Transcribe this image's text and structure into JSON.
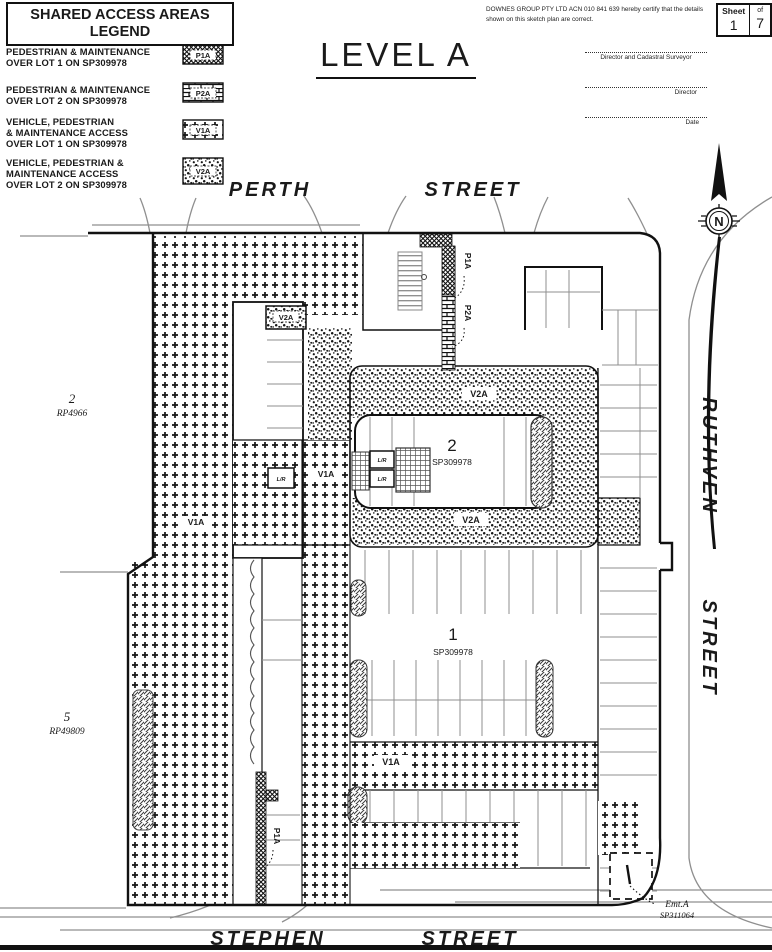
{
  "doc": {
    "title": "LEVEL A",
    "sheet": {
      "label": "Sheet",
      "of_label": "of",
      "number": "1",
      "total": "7"
    },
    "certification": {
      "line1": "DOWNES GROUP PTY LTD  ACN 010 841 639 hereby certify that the details",
      "line2": "shown on this sketch plan are correct."
    },
    "signatures": {
      "s1": "Director and Cadastral Surveyor",
      "s2": "Director",
      "s3": "Date"
    }
  },
  "legend": {
    "title1": "SHARED ACCESS AREAS",
    "title2": "LEGEND",
    "items": [
      {
        "lines": [
          "PEDESTRIAN & MAINTENANCE",
          "OVER LOT 1 ON SP309978"
        ],
        "code": "P1A"
      },
      {
        "lines": [
          "PEDESTRIAN & MAINTENANCE",
          "OVER LOT 2 ON SP309978"
        ],
        "code": "P2A"
      },
      {
        "lines": [
          "VEHICLE, PEDESTRIAN",
          "& MAINTENANCE ACCESS",
          "OVER LOT 1 ON SP309978"
        ],
        "code": "V1A"
      },
      {
        "lines": [
          "VEHICLE, PEDESTRIAN &",
          "MAINTENANCE ACCESS",
          "OVER LOT 2 ON SP309978"
        ],
        "code": "V2A"
      }
    ]
  },
  "streets": {
    "perth": "PERTH",
    "street_top": "STREET",
    "ruthven": "RUTHVEN",
    "street_right": "STREET",
    "stephen": "STEPHEN",
    "street_bottom": "STREET"
  },
  "lots": {
    "west_upper_num": "2",
    "west_upper_plan": "RP4966",
    "west_lower_num": "5",
    "west_lower_plan": "RP49809",
    "lot2_num": "2",
    "lot2_plan": "SP309978",
    "lot1_num": "1",
    "lot1_plan": "SP309978",
    "easement_name": "Emt.A",
    "easement_plan": "SP311064"
  },
  "labels": {
    "v1a": "V1A",
    "v2a": "V2A",
    "p1a": "P1A",
    "p2a": "P2A",
    "lr": "L/R",
    "north": "N"
  },
  "colors": {
    "ink": "#1a1a1a",
    "kerb": "#8f8f8f",
    "paper": "#ffffff"
  }
}
